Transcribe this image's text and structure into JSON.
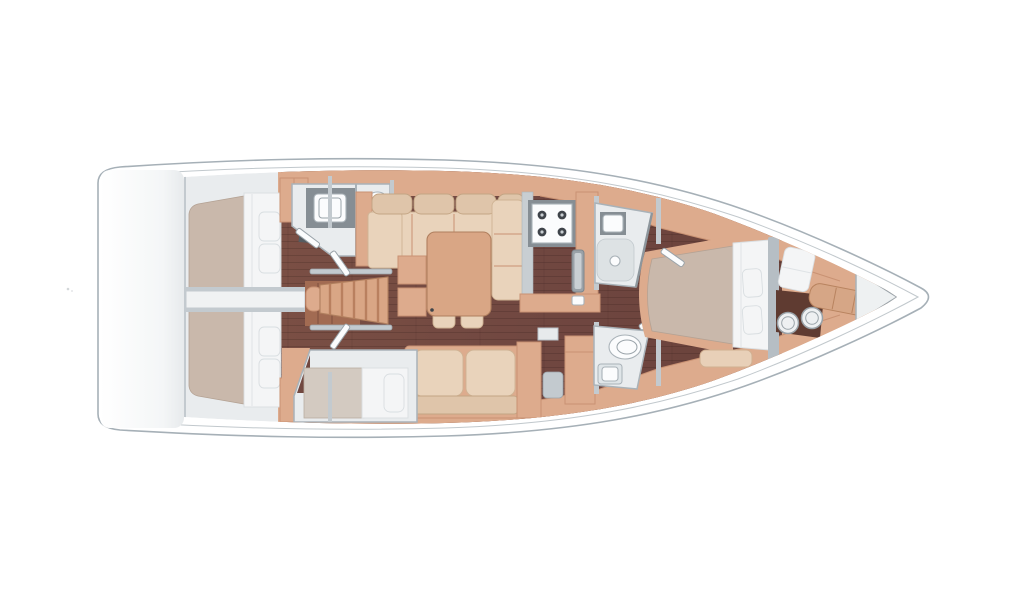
{
  "vessel": {
    "type": "sailing-yacht-interior-floor-plan",
    "view": "top-down",
    "orientation": "bow-right-stern-left"
  },
  "palette": {
    "background": "#ffffff",
    "hull_line": "#a6b0b7",
    "wall_light": "#e9ecee",
    "bulkhead_gray": "#c3cacf",
    "wood_trim_light": "#ddab8d",
    "wood_trim_mid": "#c99273",
    "wood_floor_dark": "#714840",
    "wood_floor_deep": "#5f3b31",
    "mattress_taupe": "#c9b8ab",
    "bedding_white": "#f4f5f6",
    "upholstery_beige": "#e9d3bb",
    "upholstery_back": "#dfc5aa",
    "table_wood": "#d9a685",
    "counter_gray": "#868e94",
    "counter_light": "#c8ced2",
    "shower_gray": "#dde2e4",
    "fixture_stroke": "#a9b2b8",
    "burner_dark": "#3f444a"
  },
  "rooms": [
    {
      "id": "stern-platform",
      "items": [
        "transom"
      ]
    },
    {
      "id": "aft-cabin-upper",
      "items": [
        "double-bed",
        "pillows-x2",
        "wardrobe",
        "hanging-locker"
      ]
    },
    {
      "id": "aft-cabin-lower",
      "items": [
        "double-bed",
        "pillows-x2",
        "wardrobe",
        "hanging-locker"
      ]
    },
    {
      "id": "aft-head-upper",
      "items": [
        "vanity-sink",
        "toilet",
        "door"
      ]
    },
    {
      "id": "companionway",
      "items": [
        "stairs",
        "handrails-x2"
      ]
    },
    {
      "id": "salon",
      "items": [
        "u-sofa",
        "dining-table",
        "stools-x2",
        "side-cabinets",
        "settee"
      ]
    },
    {
      "id": "galley",
      "items": [
        "stove-4-burner",
        "sink",
        "counters"
      ]
    },
    {
      "id": "berth-cabin-lower",
      "items": [
        "single-bed",
        "pillow"
      ]
    },
    {
      "id": "nav-station",
      "items": [
        "desk",
        "seat"
      ]
    },
    {
      "id": "fwd-head-upper",
      "items": [
        "shower",
        "sink",
        "glass-partition"
      ]
    },
    {
      "id": "fwd-head-lower",
      "items": [
        "toilet",
        "sink"
      ]
    },
    {
      "id": "owner-cabin",
      "items": [
        "island-double-bed",
        "pillows-x2",
        "headboard",
        "bench"
      ]
    },
    {
      "id": "bow-lounge",
      "items": [
        "vanity-desk",
        "seat-cushion",
        "stools-x2",
        "chaise"
      ]
    },
    {
      "id": "bow-locker",
      "items": [
        "anchor-locker"
      ]
    }
  ],
  "counts": {
    "cabins": 4,
    "heads": 3,
    "stove_burners": 4,
    "stools": 4,
    "pillows": 7
  }
}
